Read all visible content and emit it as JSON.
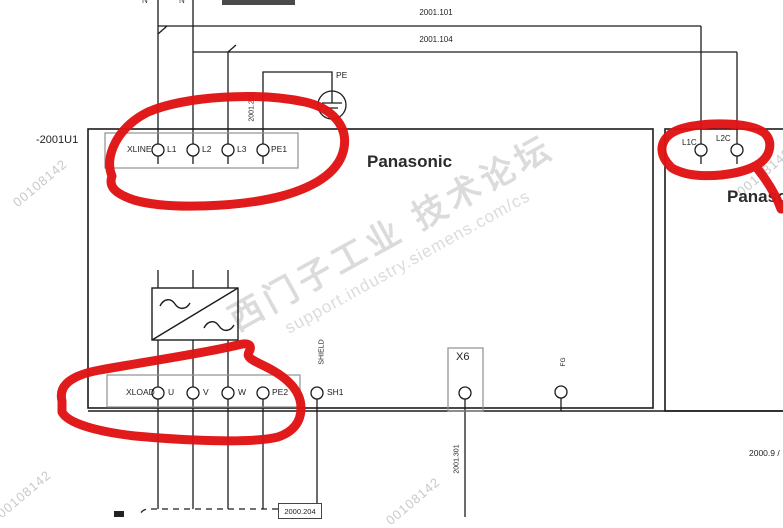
{
  "page": {
    "ref_designator": "-2001U1",
    "brand_main": "Panasonic",
    "brand_right": "Panasonic",
    "xref_right": "2000.9 /"
  },
  "wires": {
    "w101": "2001.101",
    "w104": "2001.104",
    "w202": "2001.202",
    "w301": "2001.301",
    "pe_label": "PE",
    "cable_ref": "2000.204",
    "top_fragment_1": "N",
    "top_fragment_2": "N"
  },
  "terminals": {
    "xline": {
      "name": "XLINE",
      "pins": [
        "L1",
        "L2",
        "L3",
        "PE1"
      ]
    },
    "xload": {
      "name": "XLOAD",
      "pins": [
        "U",
        "V",
        "W",
        "PE2"
      ]
    },
    "control": {
      "pins": [
        "L1C",
        "L2C"
      ]
    },
    "sh1": "SH1",
    "shield": "SHIELD",
    "x6": "X6",
    "fg": "FG"
  },
  "watermarks": {
    "id": "00108142",
    "cjk": "西门子工业 技术论坛",
    "url": "support.industry.siemens.com/cs"
  },
  "colors": {
    "annotation_red": "#e01212",
    "line_black": "#1c1c1c",
    "box_gray": "#8f8f8f",
    "watermark_gray": "#c9c9c9"
  }
}
